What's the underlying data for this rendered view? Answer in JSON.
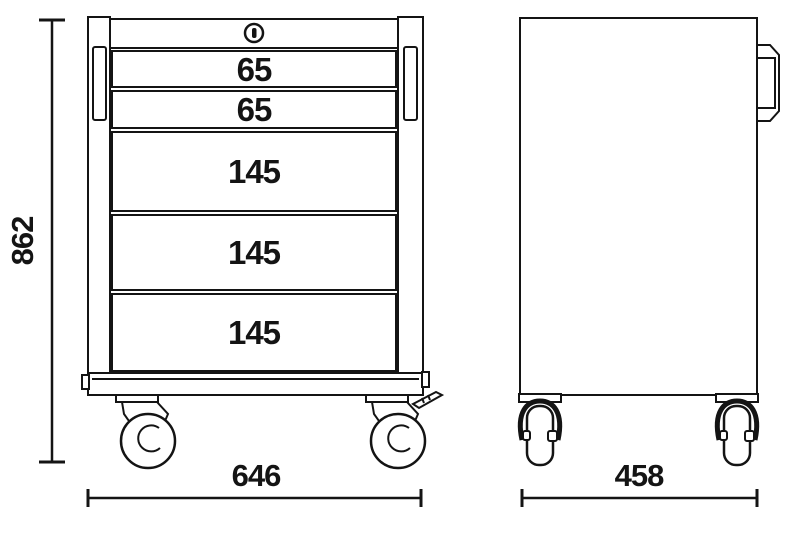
{
  "front_view": {
    "lock_icon": "keyhole-lock-icon",
    "drawers": [
      {
        "label": "65"
      },
      {
        "label": "65"
      },
      {
        "label": "145"
      },
      {
        "label": "145"
      },
      {
        "label": "145"
      }
    ]
  },
  "dimensions": {
    "height": "862",
    "front_width": "646",
    "side_depth": "458"
  },
  "icons": {
    "casters": "swivel-caster-icon",
    "side_handle": "carry-handle-icon"
  },
  "colors": {
    "line": "#141414",
    "background": "#ffffff"
  }
}
